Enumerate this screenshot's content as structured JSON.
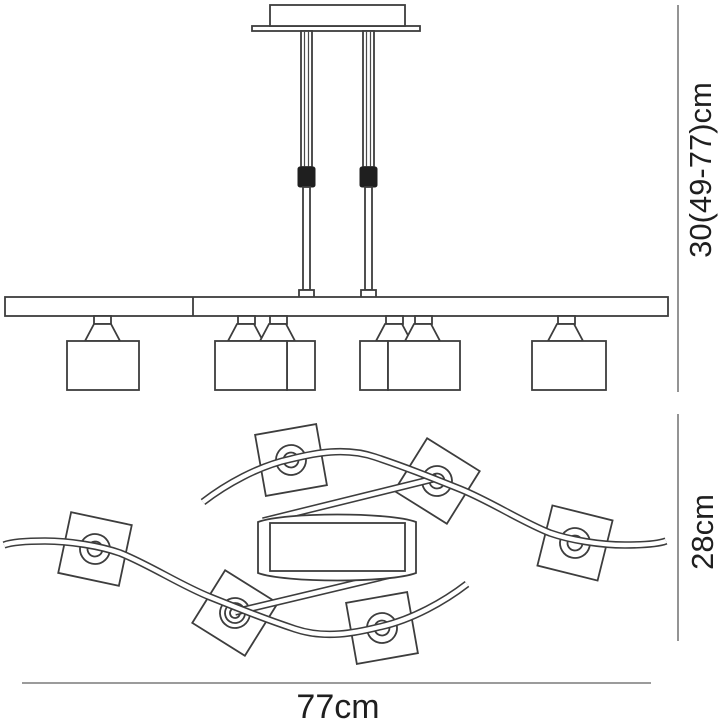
{
  "dimensions": {
    "height": "30(49-77)cm",
    "depth": "28cm",
    "width": "77cm"
  },
  "colors": {
    "background": "#ffffff",
    "drawing_line": "#3d3d3d",
    "dimension_line": "#7a7a7a",
    "label_text": "#1f1f1f",
    "adjuster_sleeve": "#1f1f1f"
  }
}
